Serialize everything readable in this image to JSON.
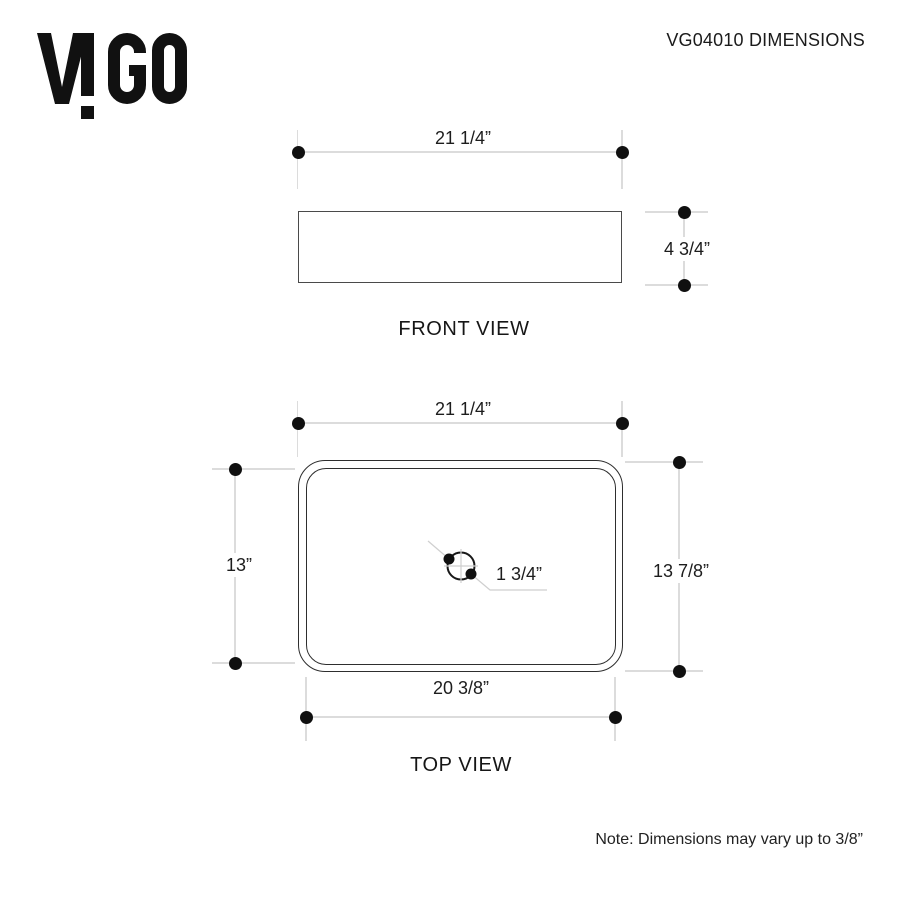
{
  "header": {
    "brand": "VIGO",
    "title": "VG04010 DIMENSIONS"
  },
  "front_view": {
    "label": "FRONT VIEW",
    "width_dim": "21 1/4”",
    "height_dim": "4 3/4”"
  },
  "top_view": {
    "label": "TOP VIEW",
    "outer_width_dim": "21 1/4”",
    "inner_height_dim": "13”",
    "outer_height_dim": "13 7/8”",
    "inner_width_dim": "20 3/8”",
    "drain_dim": "1 3/4”"
  },
  "footer": {
    "note": "Note: Dimensions may vary up to 3/8”"
  },
  "colors": {
    "ink": "#1c1c1c",
    "outline_dark": "#2e2e2e",
    "outline_front": "#4a4a4a",
    "construction_line": "#dcdcdc",
    "dot": "#101010",
    "background": "#ffffff"
  }
}
